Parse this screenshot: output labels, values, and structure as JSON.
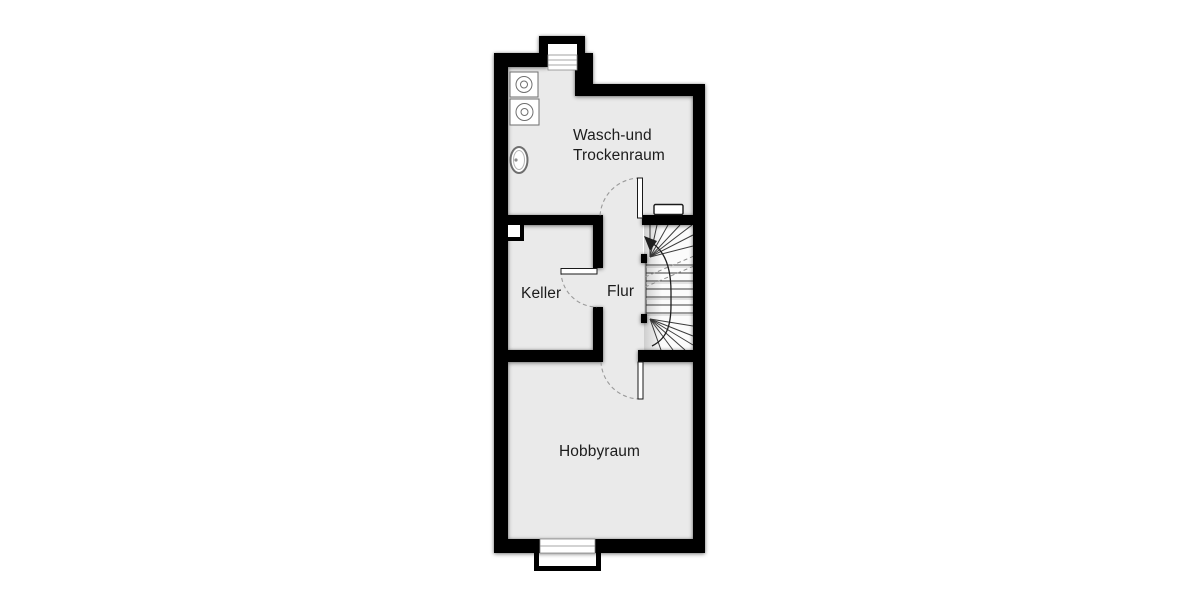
{
  "plan": {
    "rooms": {
      "wasch_trockenraum": {
        "label_line1": "Wasch-und",
        "label_line2": "Trockenraum"
      },
      "keller": {
        "label": "Keller"
      },
      "flur": {
        "label": "Flur"
      },
      "hobbyraum": {
        "label": "Hobbyraum"
      }
    },
    "features": {
      "washing_machines": 2,
      "sink": "laundry-sink",
      "radiator": "radiator",
      "staircase": "winder-staircase-with-up-arrow",
      "window_top": "basement-window-with-light-well",
      "window_bottom": "basement-window-with-light-well",
      "doors": [
        "wasch-trockenraum-door",
        "keller-door",
        "hobbyraum-door"
      ],
      "chimney": "chimney-duct"
    },
    "colors": {
      "wall": "#000000",
      "floor": "#eaeaea",
      "background": "#ffffff",
      "label": "#1c1c1c",
      "door_arc": "#9a9a9a",
      "stair_fill": "#fbfbfb",
      "stair_line": "#3c3c3c",
      "walk_line": "#1f1f1f"
    }
  }
}
